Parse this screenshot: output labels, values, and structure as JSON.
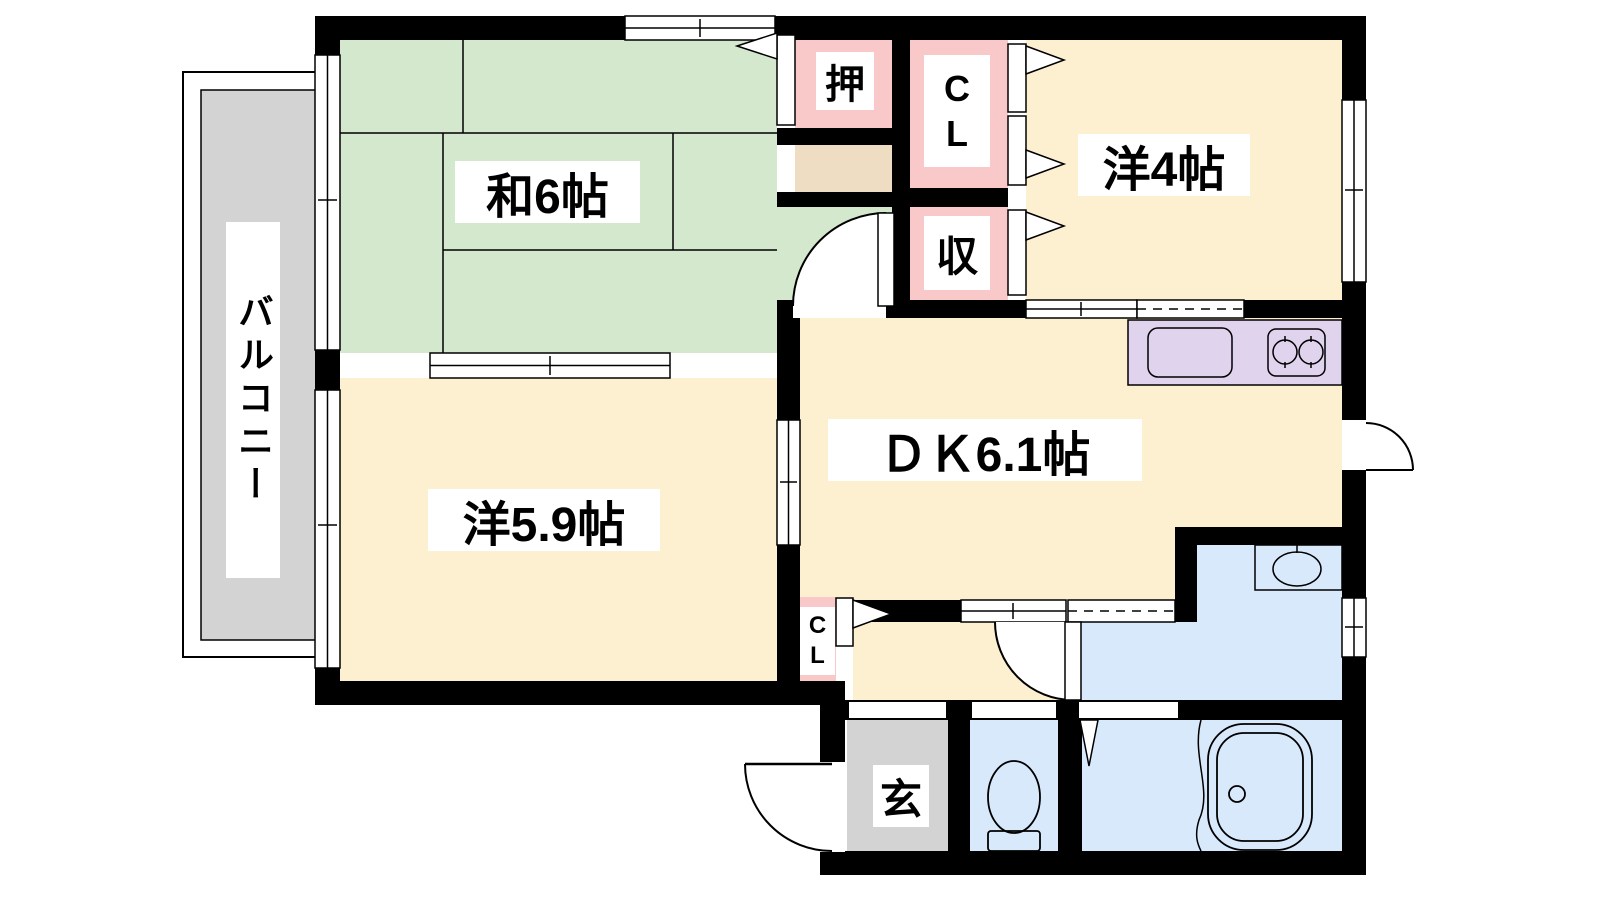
{
  "diagram_type": "apartment-floor-plan",
  "rooms": {
    "washitsu": {
      "label": "和6帖"
    },
    "western4": {
      "label": "洋4帖"
    },
    "western59": {
      "label": "洋5.9帖"
    },
    "dining_kitchen": {
      "label": "ＤＫ6.1帖"
    },
    "balcony": {
      "label": "バルコニー"
    },
    "entrance": {
      "label": "玄"
    },
    "oshiire": {
      "label": "押"
    },
    "closet_upper": {
      "line1": "C",
      "line2": "L"
    },
    "storage": {
      "label": "収"
    },
    "closet_lower": {
      "line1": "C",
      "line2": "L"
    }
  },
  "fixtures": [
    "kitchen-sink",
    "gas-stove",
    "wash-basin",
    "toilet",
    "bathtub"
  ],
  "colors": {
    "wall": "#000000",
    "tatami_green": "#d3e8cd",
    "room_cream": "#fdf0d1",
    "closet_pink": "#f9c8c8",
    "shelf_tan": "#eeddc3",
    "kitchen_lavender": "#e0d3ed",
    "water_blue": "#d9e9fc",
    "gray": "#d3d3d3"
  }
}
